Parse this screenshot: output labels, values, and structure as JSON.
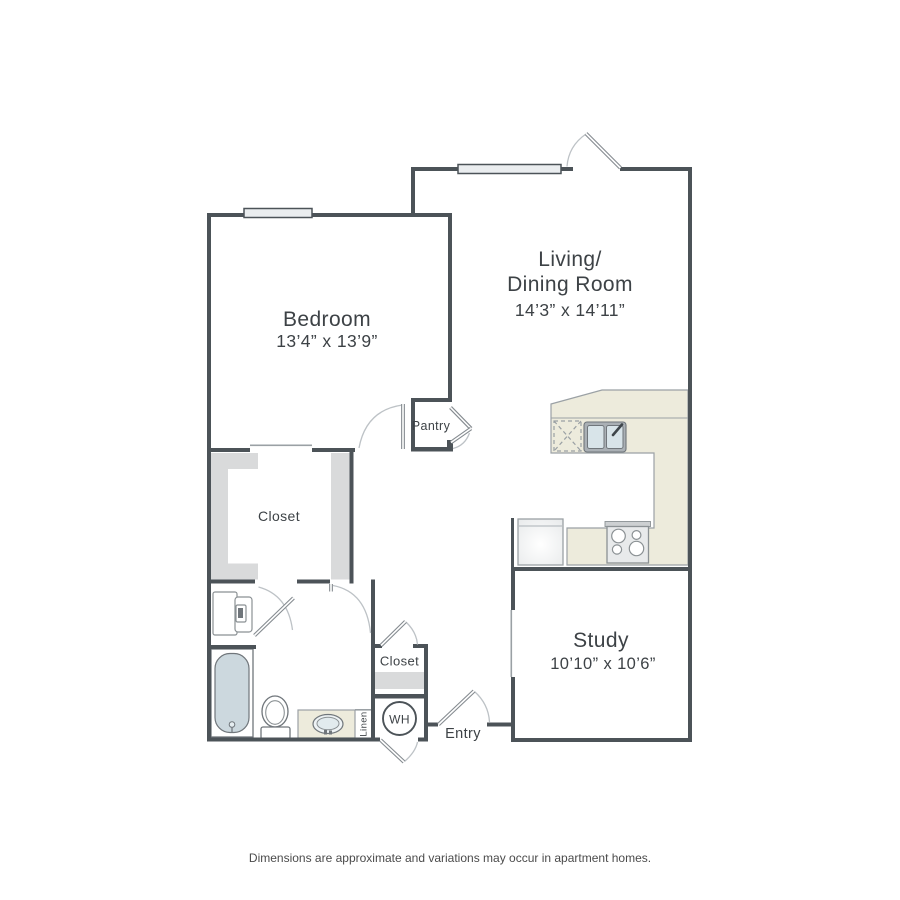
{
  "rooms": {
    "bedroom": {
      "name": "Bedroom",
      "dims": "13’4” x 13’9”"
    },
    "living_dining": {
      "name_line1": "Living/",
      "name_line2": "Dining Room",
      "dims": "14’3” x 14’11”"
    },
    "study": {
      "name": "Study",
      "dims": "10’10” x 10’6”"
    },
    "bedroom_closet": {
      "name": "Closet"
    },
    "hall_closet": {
      "name": "Closet"
    },
    "pantry": {
      "name": "Pantry"
    },
    "entry": {
      "name": "Entry"
    },
    "linen": {
      "name": "Linen"
    },
    "water_heater": {
      "abbr": "WH"
    }
  },
  "footnote": "Dimensions are approximate and variations may occur in apartment homes.",
  "colors": {
    "wall": "#4c5358",
    "counter": "#edebdc",
    "tub": "#ccd8de",
    "shelf": "#d9dadb",
    "window": "#eaedef",
    "label_text": "#3d4246"
  }
}
